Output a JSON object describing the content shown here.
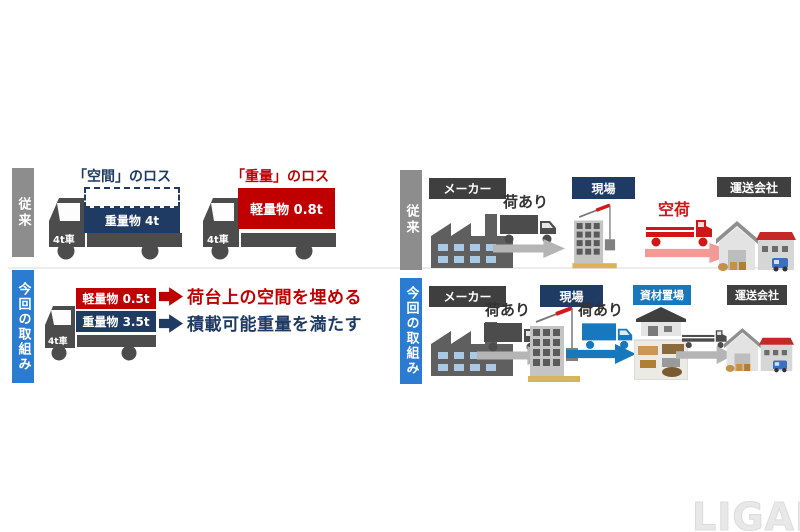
{
  "watermark": "LIGARE",
  "colors": {
    "navy": "#1f3a63",
    "red": "#c00000",
    "truck_red": "#d01616",
    "blue_bar": "#2b7bd1",
    "bright_blue": "#1878be",
    "gray_bar": "#8d8d8d",
    "truck_gray": "#4c4c4c",
    "arrow_gray": "#b5b5b5",
    "arrow_pink": "#f29a94",
    "label_dark": "#3f3f3f"
  },
  "left": {
    "conv": {
      "side": "従来",
      "space_loss": "「空間」のロス",
      "weight_loss": "「重量」のロス",
      "truck1_cargo": "重量物 4t",
      "truck2_cargo": "軽量物 0.8t",
      "cab": "4t車"
    },
    "init": {
      "side": "今回の取組み",
      "cab": "4t車",
      "light_cargo": "軽量物 0.5t",
      "heavy_cargo": "重量物 3.5t",
      "point_space": "荷台上の空間を埋める",
      "point_weight": "積載可能重量を満たす"
    }
  },
  "right": {
    "conv": {
      "side": "従来",
      "maker": "メーカー",
      "loaded": "荷あり",
      "site": "現場",
      "empty": "空荷",
      "carrier": "運送会社"
    },
    "init": {
      "side": "今回の取組み",
      "maker": "メーカー",
      "loaded1": "荷あり",
      "site": "現場",
      "loaded2": "荷あり",
      "yard": "資材置場",
      "carrier": "運送会社"
    }
  }
}
